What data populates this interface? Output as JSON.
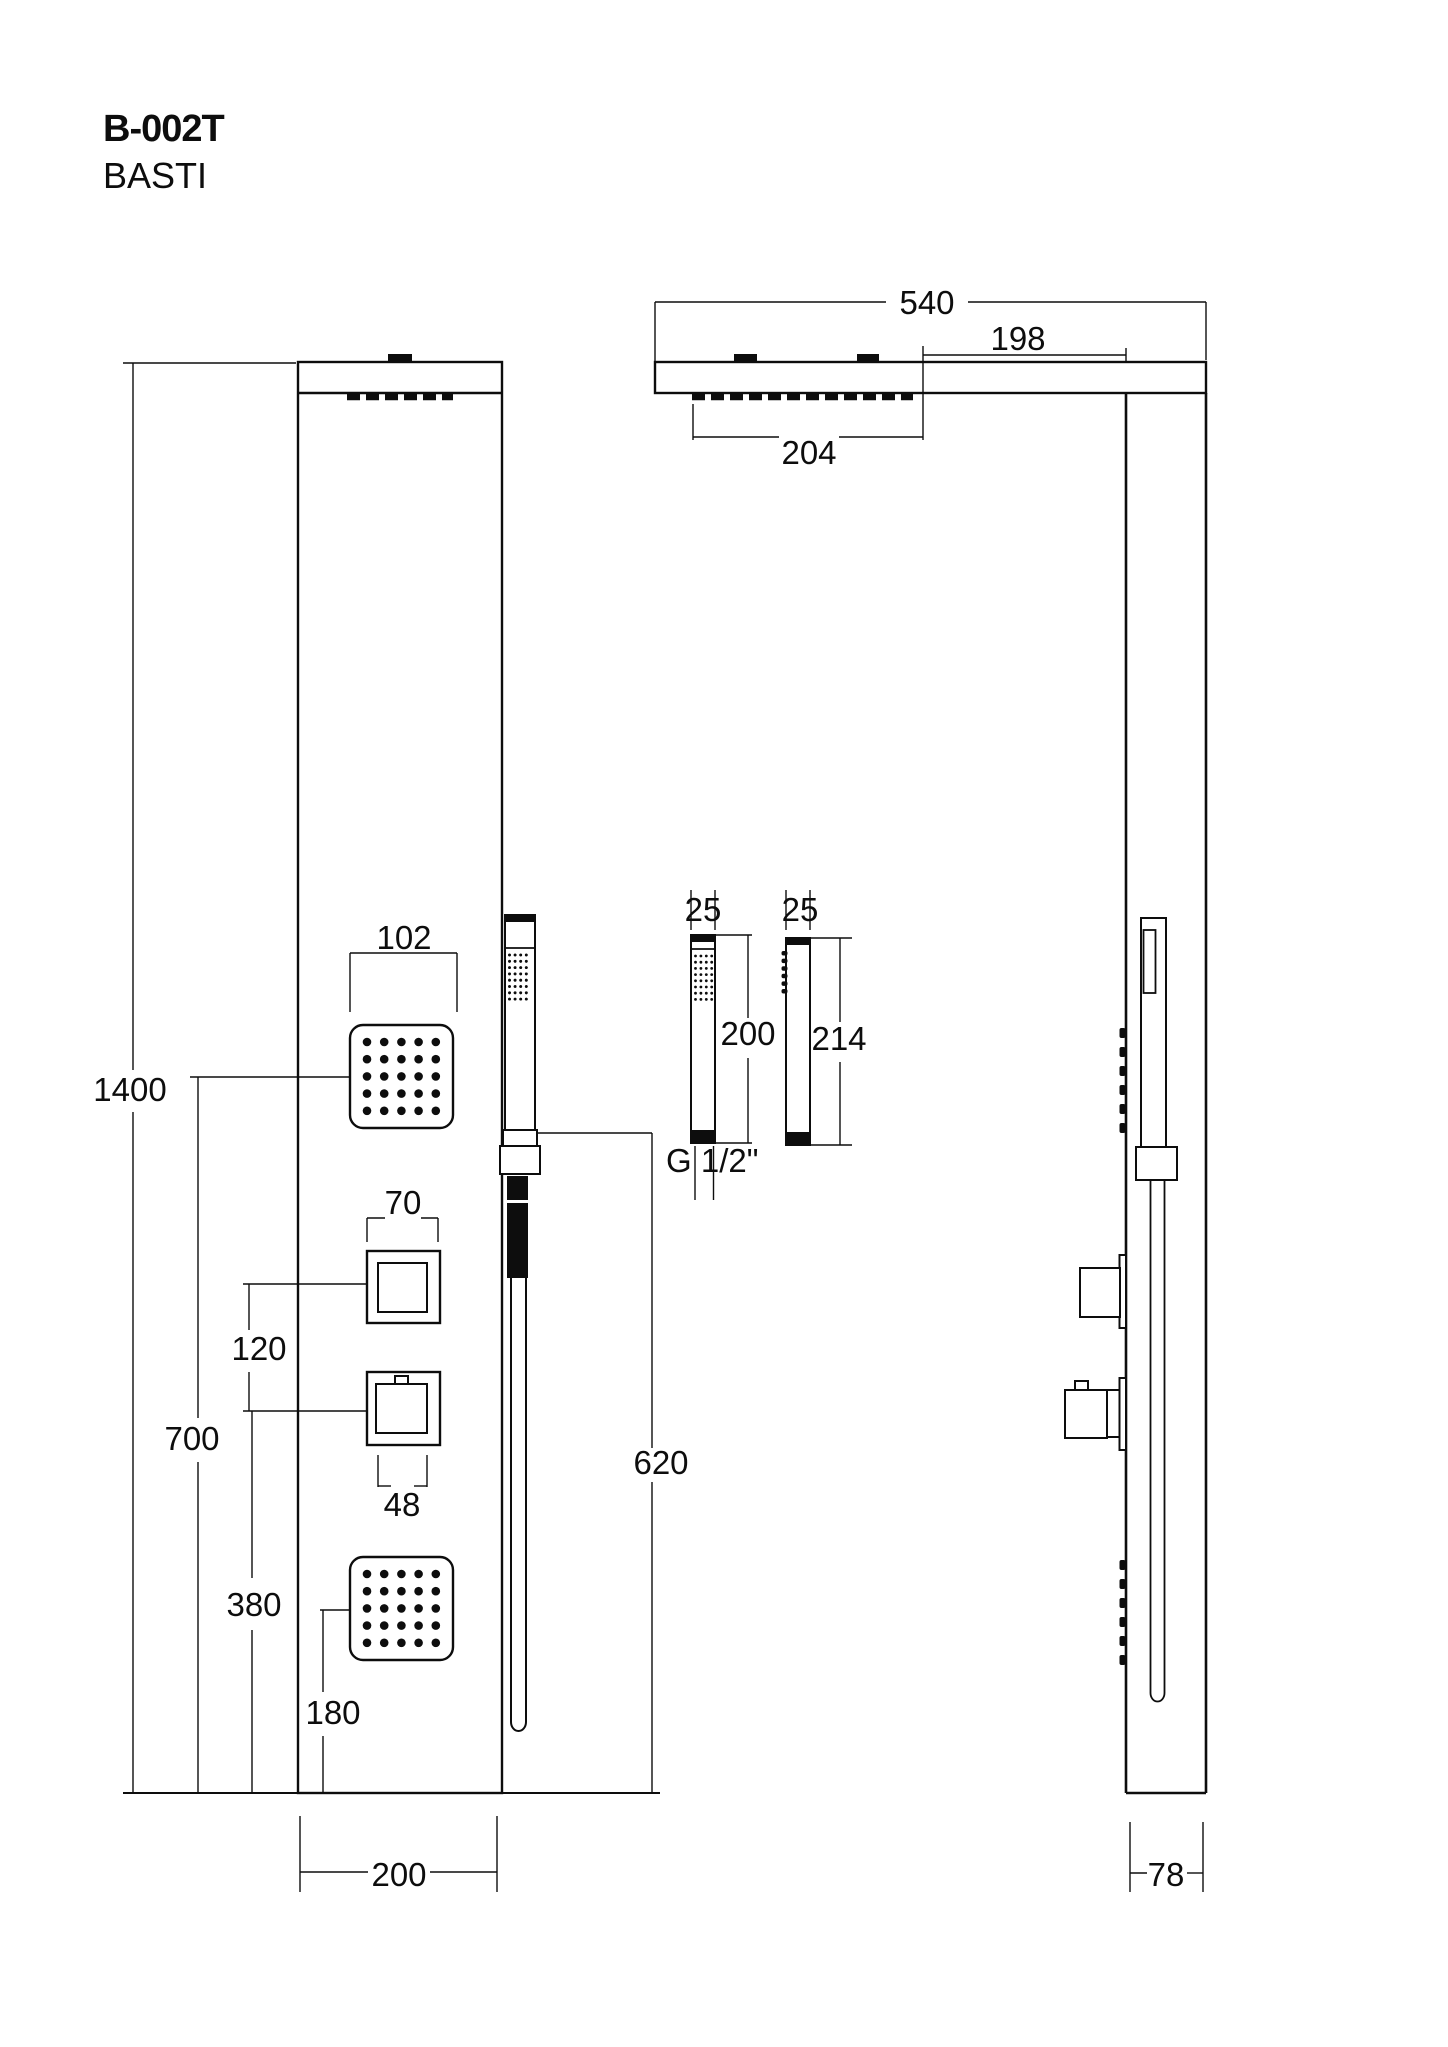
{
  "title": {
    "model": "B-002T",
    "name": "BASTI"
  },
  "dims": {
    "front": {
      "total_height": "1400",
      "upper_jet_height": "700",
      "lower_knob_height": "380",
      "lower_jet_height": "180",
      "knob_spacing": "120",
      "jet_width": "102",
      "knob_plate_width": "70",
      "knob_width": "48",
      "hose_drop": "620",
      "panel_width": "200"
    },
    "side": {
      "arm_projection": "540",
      "head_to_panel": "198",
      "head_length": "204",
      "panel_depth": "78"
    },
    "hand_shower": {
      "front_width": "25",
      "front_length": "200",
      "side_width": "25",
      "side_length": "214",
      "thread": "G 1/2\""
    }
  },
  "colors": {
    "line": "#0d0d0d",
    "background": "#ffffff"
  }
}
